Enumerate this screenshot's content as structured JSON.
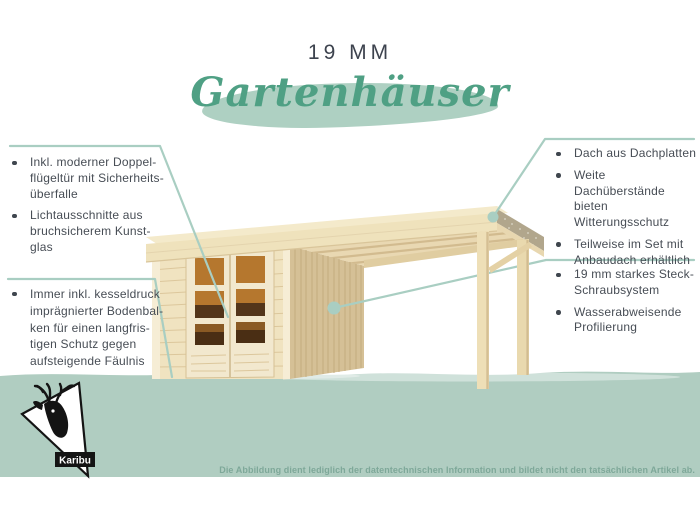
{
  "header": {
    "size_label": "19 MM",
    "title": "Gartenhäuser"
  },
  "callouts": {
    "left_top": {
      "items": [
        "Inkl. moderner Doppel-\nflügeltür mit Sicherheits-\nüberfalle",
        "Lichtausschnitte aus\nbruchsicherem Kunst-\nglas"
      ]
    },
    "left_bottom": {
      "items": [
        "Immer inkl. kesseldruck\nimprägnierter Bodenbal-\nken für einen langfris-\ntigen Schutz gegen\naufsteigende Fäulnis"
      ]
    },
    "right_top": {
      "items": [
        "Dach aus Dachplatten",
        "Weite Dachüberstände\nbieten Witterungsschutz",
        "Teilweise im Set mit\nAnbaudach erhältlich"
      ]
    },
    "right_bottom": {
      "items": [
        "19 mm starkes Steck-\nSchraubsystem",
        "Wasserabweisende\nProfilierung"
      ]
    }
  },
  "logo": {
    "brand": "Karibu"
  },
  "footer": {
    "disclaimer": "Die Abbildung dient lediglich der datentechnischen Information und bildet nicht den tatsächlichen Artikel ab."
  },
  "colors": {
    "band_sage": "#b0cdc1",
    "accent_line": "#a9cec2",
    "title_green": "#4fa084",
    "brush_sage": "#aed0c2",
    "text_dark": "#474d55",
    "disclaimer_green": "#7ea899",
    "wood_light": "#f0e3c0",
    "wood_side": "#d5c096",
    "glass_orange": "#b5772e"
  }
}
